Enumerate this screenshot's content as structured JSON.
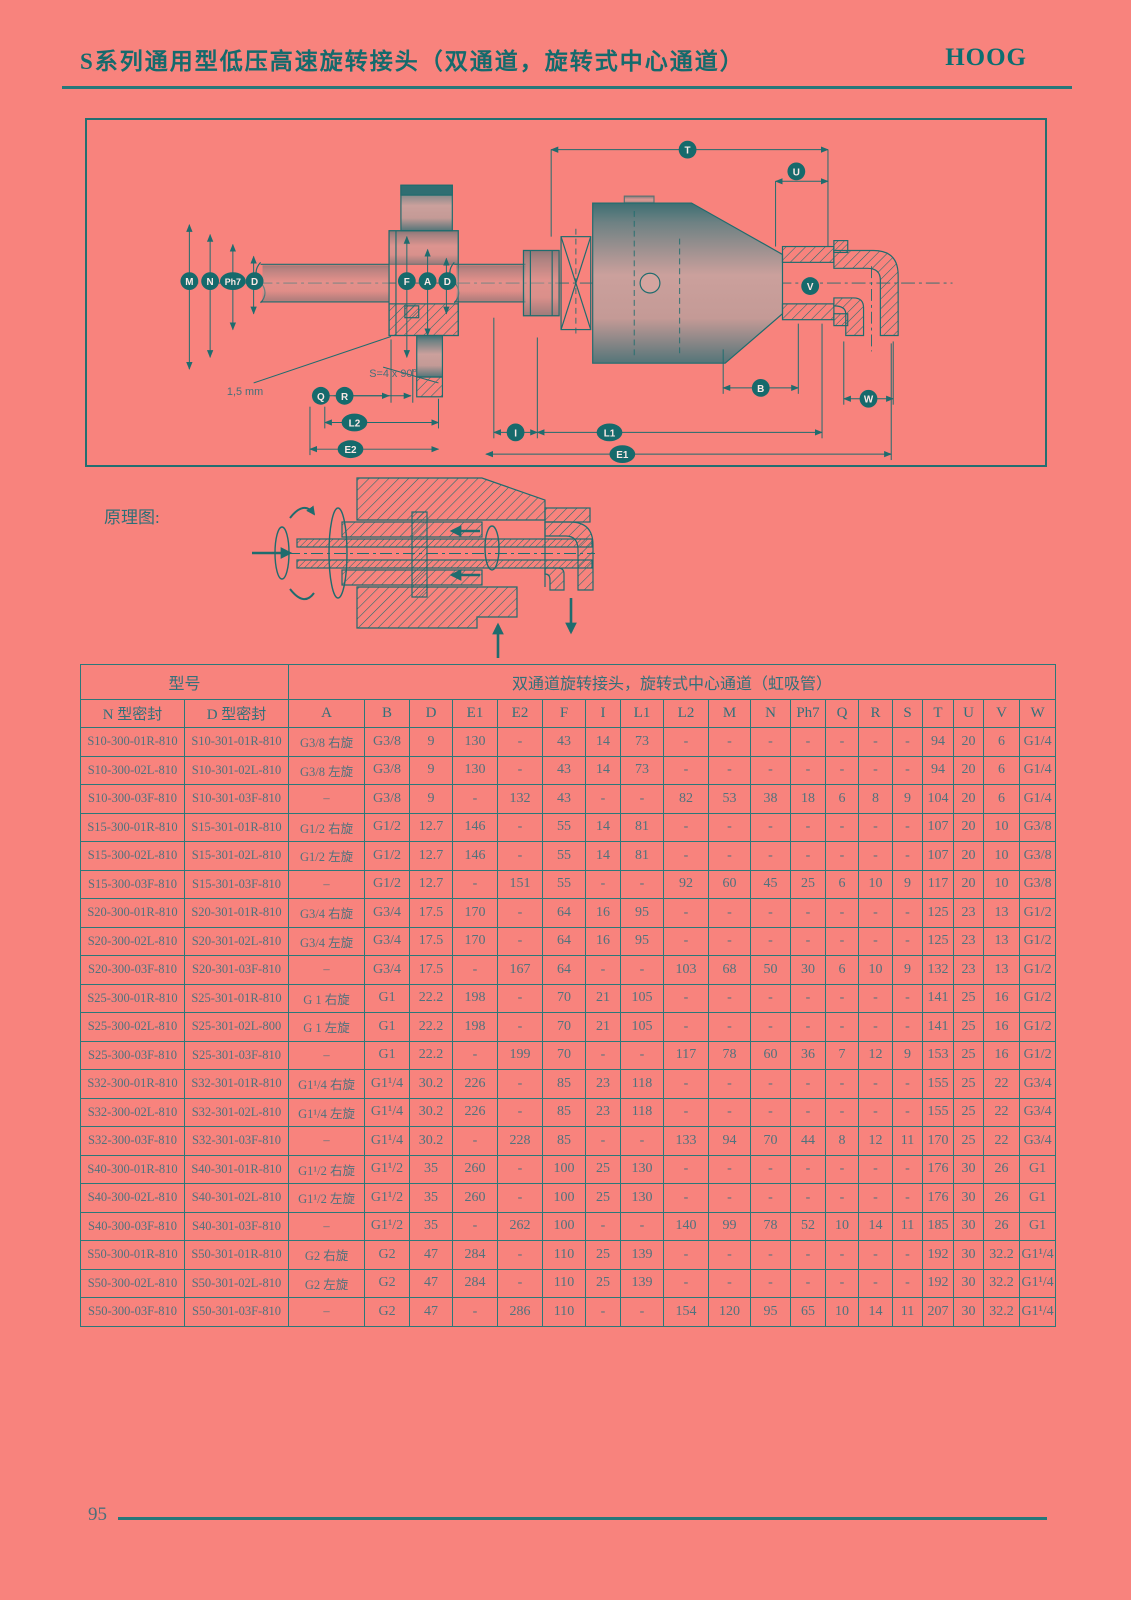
{
  "page": {
    "title": "S系列通用型低压高速旋转接头（双通道，旋转式中心通道）",
    "brand": "HOOG",
    "principle_label": "原理图:",
    "page_number": "95"
  },
  "colors": {
    "background": "#f8837d",
    "accent_teal": "#1f6c6e",
    "table_grid": "#2c7879",
    "table_text": "#50727d"
  },
  "drawing": {
    "badges": {
      "m": "M",
      "n": "N",
      "ph7": "Ph7",
      "d": "D",
      "f": "F",
      "a": "A",
      "q": "Q",
      "r": "R",
      "l2": "L2",
      "e2": "E2",
      "t": "T",
      "u": "U",
      "v": "V",
      "b": "B",
      "w": "W",
      "i": "I",
      "l1": "L1",
      "e1": "E1"
    },
    "annotations": {
      "gap": "1,5 mm",
      "slots": "S=4 x 90°"
    }
  },
  "table": {
    "group_header": {
      "model": "型号",
      "spec": "双通道旋转接头，旋转式中心通道（虹吸管）"
    },
    "columns": [
      "N 型密封",
      "D 型密封",
      "A",
      "B",
      "D",
      "E1",
      "E2",
      "F",
      "I",
      "L1",
      "L2",
      "M",
      "N",
      "Ph7",
      "Q",
      "R",
      "S",
      "T",
      "U",
      "V",
      "W"
    ],
    "rows": [
      [
        "S10-300-01R-810",
        "S10-301-01R-810",
        "G3/8 右旋",
        "G3/8",
        "9",
        "130",
        "-",
        "43",
        "14",
        "73",
        "-",
        "-",
        "-",
        "-",
        "-",
        "-",
        "-",
        "94",
        "20",
        "6",
        "G1/4"
      ],
      [
        "S10-300-02L-810",
        "S10-301-02L-810",
        "G3/8 左旋",
        "G3/8",
        "9",
        "130",
        "-",
        "43",
        "14",
        "73",
        "-",
        "-",
        "-",
        "-",
        "-",
        "-",
        "-",
        "94",
        "20",
        "6",
        "G1/4"
      ],
      [
        "S10-300-03F-810",
        "S10-301-03F-810",
        "–",
        "G3/8",
        "9",
        "-",
        "132",
        "43",
        "-",
        "-",
        "82",
        "53",
        "38",
        "18",
        "6",
        "8",
        "9",
        "104",
        "20",
        "6",
        "G1/4"
      ],
      [
        "S15-300-01R-810",
        "S15-301-01R-810",
        "G1/2 右旋",
        "G1/2",
        "12.7",
        "146",
        "-",
        "55",
        "14",
        "81",
        "-",
        "-",
        "-",
        "-",
        "-",
        "-",
        "-",
        "107",
        "20",
        "10",
        "G3/8"
      ],
      [
        "S15-300-02L-810",
        "S15-301-02L-810",
        "G1/2 左旋",
        "G1/2",
        "12.7",
        "146",
        "-",
        "55",
        "14",
        "81",
        "-",
        "-",
        "-",
        "-",
        "-",
        "-",
        "-",
        "107",
        "20",
        "10",
        "G3/8"
      ],
      [
        "S15-300-03F-810",
        "S15-301-03F-810",
        "–",
        "G1/2",
        "12.7",
        "-",
        "151",
        "55",
        "-",
        "-",
        "92",
        "60",
        "45",
        "25",
        "6",
        "10",
        "9",
        "117",
        "20",
        "10",
        "G3/8"
      ],
      [
        "S20-300-01R-810",
        "S20-301-01R-810",
        "G3/4 右旋",
        "G3/4",
        "17.5",
        "170",
        "-",
        "64",
        "16",
        "95",
        "-",
        "-",
        "-",
        "-",
        "-",
        "-",
        "-",
        "125",
        "23",
        "13",
        "G1/2"
      ],
      [
        "S20-300-02L-810",
        "S20-301-02L-810",
        "G3/4 左旋",
        "G3/4",
        "17.5",
        "170",
        "-",
        "64",
        "16",
        "95",
        "-",
        "-",
        "-",
        "-",
        "-",
        "-",
        "-",
        "125",
        "23",
        "13",
        "G1/2"
      ],
      [
        "S20-300-03F-810",
        "S20-301-03F-810",
        "–",
        "G3/4",
        "17.5",
        "-",
        "167",
        "64",
        "-",
        "-",
        "103",
        "68",
        "50",
        "30",
        "6",
        "10",
        "9",
        "132",
        "23",
        "13",
        "G1/2"
      ],
      [
        "S25-300-01R-810",
        "S25-301-01R-810",
        "G 1 右旋",
        "G1",
        "22.2",
        "198",
        "-",
        "70",
        "21",
        "105",
        "-",
        "-",
        "-",
        "-",
        "-",
        "-",
        "-",
        "141",
        "25",
        "16",
        "G1/2"
      ],
      [
        "S25-300-02L-810",
        "S25-301-02L-800",
        "G 1 左旋",
        "G1",
        "22.2",
        "198",
        "-",
        "70",
        "21",
        "105",
        "-",
        "-",
        "-",
        "-",
        "-",
        "-",
        "-",
        "141",
        "25",
        "16",
        "G1/2"
      ],
      [
        "S25-300-03F-810",
        "S25-301-03F-810",
        "–",
        "G1",
        "22.2",
        "-",
        "199",
        "70",
        "-",
        "-",
        "117",
        "78",
        "60",
        "36",
        "7",
        "12",
        "9",
        "153",
        "25",
        "16",
        "G1/2"
      ],
      [
        "S32-300-01R-810",
        "S32-301-01R-810",
        "G1¹/4 右旋",
        "G1¹/4",
        "30.2",
        "226",
        "-",
        "85",
        "23",
        "118",
        "-",
        "-",
        "-",
        "-",
        "-",
        "-",
        "-",
        "155",
        "25",
        "22",
        "G3/4"
      ],
      [
        "S32-300-02L-810",
        "S32-301-02L-810",
        "G1¹/4 左旋",
        "G1¹/4",
        "30.2",
        "226",
        "-",
        "85",
        "23",
        "118",
        "-",
        "-",
        "-",
        "-",
        "-",
        "-",
        "-",
        "155",
        "25",
        "22",
        "G3/4"
      ],
      [
        "S32-300-03F-810",
        "S32-301-03F-810",
        "–",
        "G1¹/4",
        "30.2",
        "-",
        "228",
        "85",
        "-",
        "-",
        "133",
        "94",
        "70",
        "44",
        "8",
        "12",
        "11",
        "170",
        "25",
        "22",
        "G3/4"
      ],
      [
        "S40-300-01R-810",
        "S40-301-01R-810",
        "G1¹/2 右旋",
        "G1¹/2",
        "35",
        "260",
        "-",
        "100",
        "25",
        "130",
        "-",
        "-",
        "-",
        "-",
        "-",
        "-",
        "-",
        "176",
        "30",
        "26",
        "G1"
      ],
      [
        "S40-300-02L-810",
        "S40-301-02L-810",
        "G1¹/2 左旋",
        "G1¹/2",
        "35",
        "260",
        "-",
        "100",
        "25",
        "130",
        "-",
        "-",
        "-",
        "-",
        "-",
        "-",
        "-",
        "176",
        "30",
        "26",
        "G1"
      ],
      [
        "S40-300-03F-810",
        "S40-301-03F-810",
        "–",
        "G1¹/2",
        "35",
        "-",
        "262",
        "100",
        "-",
        "-",
        "140",
        "99",
        "78",
        "52",
        "10",
        "14",
        "11",
        "185",
        "30",
        "26",
        "G1"
      ],
      [
        "S50-300-01R-810",
        "S50-301-01R-810",
        "G2 右旋",
        "G2",
        "47",
        "284",
        "-",
        "110",
        "25",
        "139",
        "-",
        "-",
        "-",
        "-",
        "-",
        "-",
        "-",
        "192",
        "30",
        "32.2",
        "G1¹/4"
      ],
      [
        "S50-300-02L-810",
        "S50-301-02L-810",
        "G2 左旋",
        "G2",
        "47",
        "284",
        "-",
        "110",
        "25",
        "139",
        "-",
        "-",
        "-",
        "-",
        "-",
        "-",
        "-",
        "192",
        "30",
        "32.2",
        "G1¹/4"
      ],
      [
        "S50-300-03F-810",
        "S50-301-03F-810",
        "–",
        "G2",
        "47",
        "-",
        "286",
        "110",
        "-",
        "-",
        "154",
        "120",
        "95",
        "65",
        "10",
        "14",
        "11",
        "207",
        "30",
        "32.2",
        "G1¹/4"
      ]
    ]
  }
}
